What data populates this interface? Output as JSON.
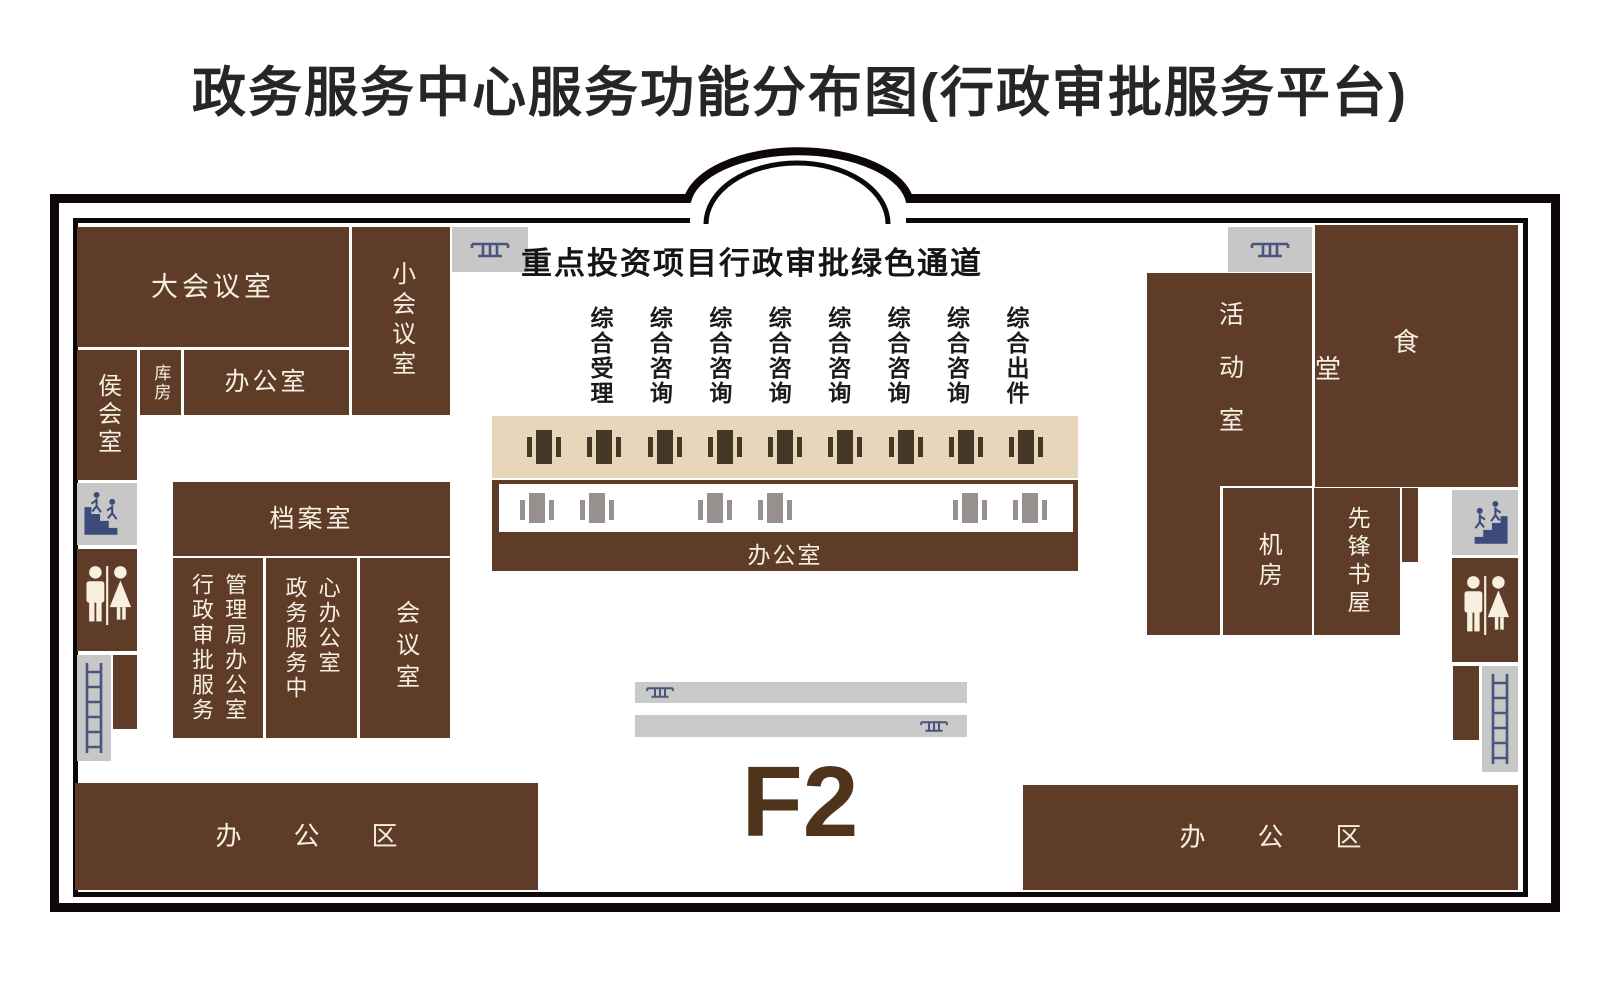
{
  "title": "政务服务中心服务功能分布图(行政审批服务平台)",
  "floor": {
    "label": "F2"
  },
  "building": {
    "green_channel_heading": "重点投资项目行政审批绿色通道",
    "counter_labels": [
      "综合受理",
      "综合咨询",
      "综合咨询",
      "综合咨询",
      "综合咨询",
      "综合咨询",
      "综合咨询",
      "综合出件"
    ],
    "counter_back_office": "办公室",
    "counter_window_count": 9,
    "back_desk_count": 6
  },
  "rooms": {
    "large_meeting": "大会议室",
    "small_meeting": "小会议室",
    "waiting": "侯会室",
    "storage": "库房",
    "office_nw": "办公室",
    "archives": "档案室",
    "approval_bureau_col_left": "行政审批服务",
    "approval_bureau_col_right": "管理局办公室",
    "service_center_col_left": "政务服务中",
    "service_center_col_right": "心办公室",
    "meeting": "会议室",
    "office_area_left": "办公区",
    "activity": "活动室",
    "canteen": "食堂",
    "machine_room": "机房",
    "bookstore": "先锋书屋",
    "office_area_right": "办公区"
  },
  "icons": {
    "escalator": "escalator-icon",
    "stairs": "stairs-icon",
    "toilet": "toilet-icon",
    "ladder": "ladder-icon",
    "desk": "desk-icon",
    "entrance": "entrance-arch"
  },
  "colors": {
    "room": "#5E3C28",
    "beige": "#E7D6B9",
    "graybox": "#C7C7C7",
    "navy": "#3B4B7B",
    "deskdark": "#453726",
    "deskgray": "#97908E",
    "wall": "#0D0708",
    "cream": "#F6EFE2"
  }
}
